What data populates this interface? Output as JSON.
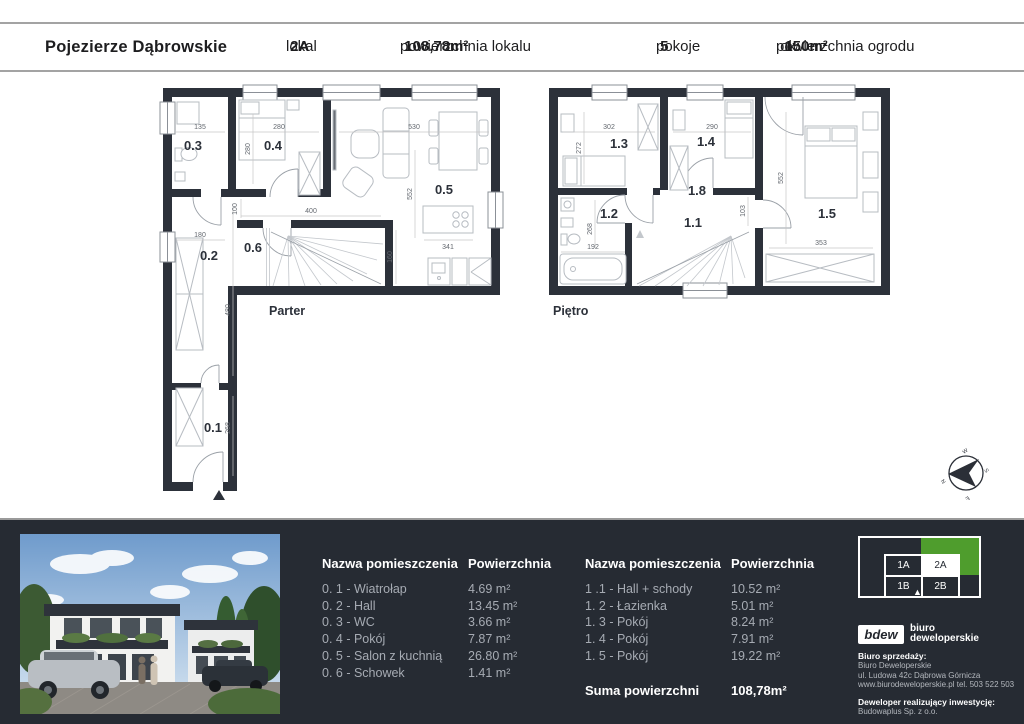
{
  "header": {
    "title": "Pojezierze Dąbrowskie",
    "lokal_label": "lokal",
    "lokal_value": "2A",
    "area_label": "powierzchnia lokalu",
    "area_value": "108,78m²",
    "rooms_label": "pokoje",
    "rooms_value": "5",
    "garden_label": "powierzchnia ogrodu",
    "garden_ok": "ok.",
    "garden_value": "150m²"
  },
  "plans": {
    "parter": {
      "label": "Parter",
      "rooms": {
        "r01": "0.1",
        "r02": "0.2",
        "r03": "0.3",
        "r04": "0.4",
        "r05": "0.5",
        "r06": "0.6"
      },
      "dims": {
        "d135": "135",
        "d280h": "280",
        "d280v": "280",
        "d530": "530",
        "d552": "552",
        "d400": "400",
        "d100": "100",
        "d341": "341",
        "d160": "160",
        "d180": "180",
        "d480": "480",
        "d268": "268"
      }
    },
    "pietro": {
      "label": "Piętro",
      "rooms": {
        "r11": "1.1",
        "r12": "1.2",
        "r13": "1.3",
        "r14": "1.4",
        "r15": "1.5",
        "r18": "1.8"
      },
      "dims": {
        "d302": "302",
        "d272": "272",
        "d290": "290",
        "d552": "552",
        "d103": "103",
        "d268": "268",
        "d192": "192",
        "d353": "353"
      }
    }
  },
  "tables": {
    "name_header": "Nazwa pomieszczenia",
    "area_header": "Powierzchnia",
    "left": {
      "rows": [
        {
          "name": "0. 1 - Wiatrołap",
          "area": "4.69 m²"
        },
        {
          "name": "0. 2 - Hall",
          "area": "13.45 m²"
        },
        {
          "name": "0. 3 - WC",
          "area": "3.66 m²"
        },
        {
          "name": "0. 4 - Pokój",
          "area": "7.87 m²"
        },
        {
          "name": "0. 5 - Salon z kuchnią",
          "area": "26.80 m²"
        },
        {
          "name": "0. 6 - Schowek",
          "area": "1.41 m²"
        }
      ]
    },
    "right": {
      "rows": [
        {
          "name": "1 .1 - Hall + schody",
          "area": "10.52 m²"
        },
        {
          "name": "1. 2 - Łazienka",
          "area": "5.01 m²"
        },
        {
          "name": "1. 3 - Pokój",
          "area": "8.24 m²"
        },
        {
          "name": "1. 4 - Pokój",
          "area": "7.91 m²"
        },
        {
          "name": "1. 5 - Pokój",
          "area": "19.22 m²"
        }
      ]
    },
    "sum_label": "Suma powierzchni",
    "sum_value": "108,78m²"
  },
  "selector": {
    "green": "#4f9d2d",
    "units": {
      "u1a": "1A",
      "u2a": "2A",
      "u1b": "1B",
      "u2b": "2B"
    },
    "active": "2A"
  },
  "company": {
    "logo_text": "bdew",
    "logo_line1": "biuro",
    "logo_line2": "deweloperskie",
    "sales_label": "Biuro sprzedaży:",
    "sales_name": "Biuro Deweloperskie",
    "sales_address": "ul. Ludowa 42c Dąbrowa Górnicza",
    "sales_contact": "www.biurodeweloperskie.pl  tel. 503 522 503",
    "developer_label": "Deweloper realizujący inwestycję:",
    "developer_name": "Budowaplus Sp. z o.o."
  },
  "compass": {
    "n": "N",
    "w": "W",
    "s": "S",
    "e": "E"
  }
}
